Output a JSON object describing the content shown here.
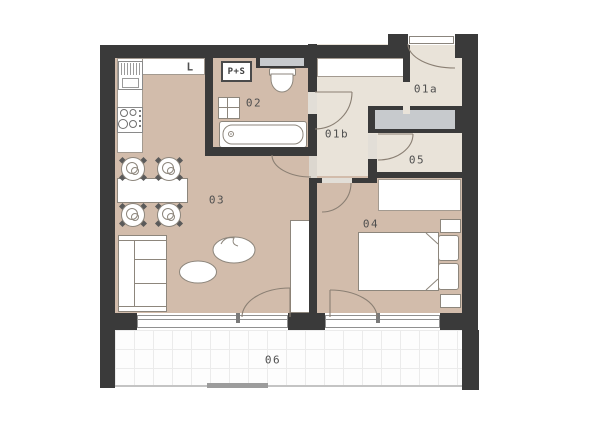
{
  "labels": {
    "r01a": "01a",
    "r01b": "01b",
    "r02": "02",
    "r03": "03",
    "r04": "04",
    "r05": "05",
    "r06": "06",
    "kitchen": "L",
    "washer": "P+S"
  },
  "colors": {
    "wall": "#3a3a3a",
    "floor_living": "#d2bcab",
    "floor_service": "#e9e3d9",
    "shaft": "#c7cacd",
    "furniture_outline": "#8d867c",
    "label_text": "#4f4f4f"
  }
}
